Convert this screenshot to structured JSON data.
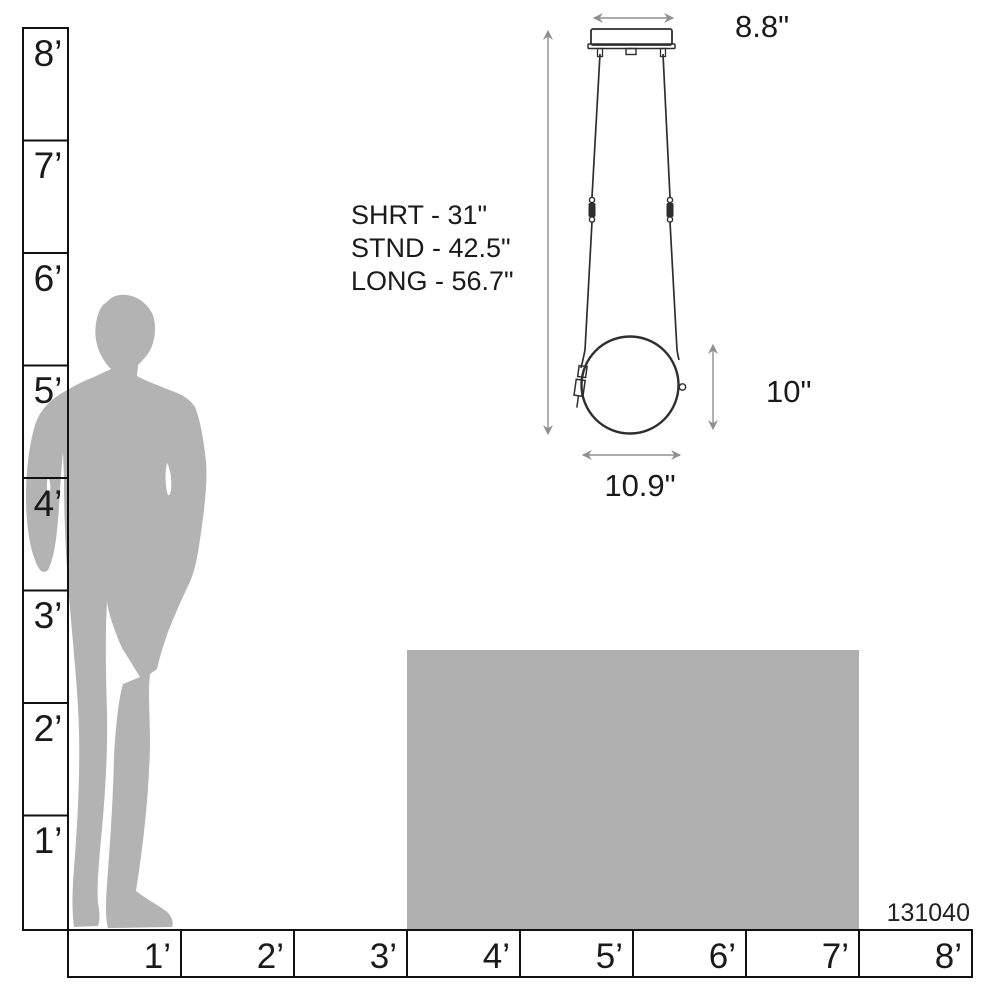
{
  "product_code": "131040",
  "colors": {
    "silhouette": "#b3b3b3",
    "table": "#b0b0b0",
    "ruler_line": "#111111",
    "text": "#1a1a1a",
    "fixture_line": "#2e2e2e",
    "dimension_line": "#8f8f8f"
  },
  "rulers": {
    "vertical_labels": [
      "8’",
      "7’",
      "6’",
      "5’",
      "4’",
      "3’",
      "2’",
      "1’"
    ],
    "horizontal_labels": [
      "1’",
      "2’",
      "3’",
      "4’",
      "5’",
      "6’",
      "7’",
      "8’"
    ]
  },
  "fixture": {
    "suspension_lengths": [
      "SHRT - 31\"",
      "STND - 42.5\"",
      "LONG - 56.7\""
    ],
    "canopy_width": "8.8\"",
    "shade_height": "10\"",
    "shade_width": "10.9\""
  }
}
